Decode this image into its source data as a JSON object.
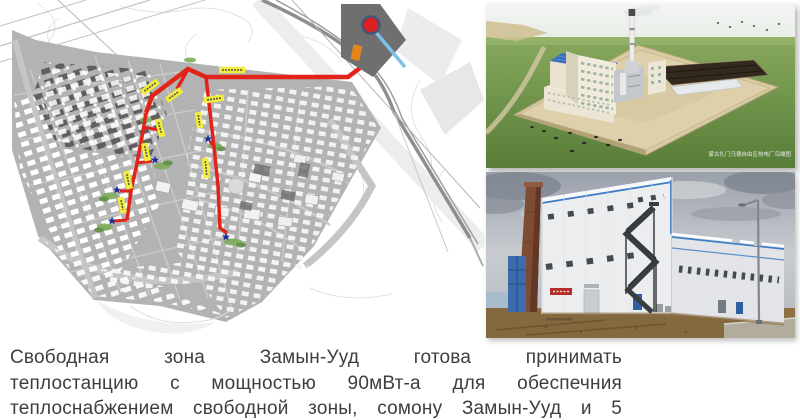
{
  "text": {
    "line1": "Свободная зона Замын-Ууд готова принимать",
    "line2": "теплостанцию с мощностью 90мВт-а для обеспечния",
    "line3": "теплоснабжением свободной зоны, сомону Замын-Ууд и 5"
  },
  "figures": {
    "map": {
      "description": "план теплосети свободной зоны Замын-Ууд",
      "pipe_color": "#e2231a",
      "pipe_label_color": "#f2ee3a",
      "substation_marker_color": "#1c2f9c",
      "plant_marker_color": "#dd1f1f"
    },
    "render": {
      "caption": "蒙古扎门乌德自由区热电厂鸟瞰图"
    }
  },
  "colors": {
    "accent_roof_blue": "#3d6fc0",
    "accent_trim_blue": "#3f7cc5",
    "grass_green": "#6f9a4a",
    "text_gray": "#3e3e3e"
  }
}
